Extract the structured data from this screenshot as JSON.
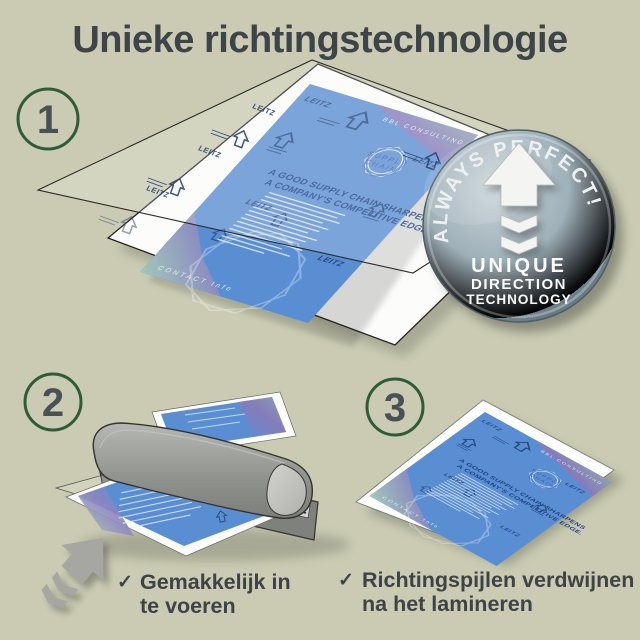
{
  "title": "Unieke richtingstechnologie",
  "steps": [
    {
      "number": "1"
    },
    {
      "number": "2"
    },
    {
      "number": "3"
    }
  ],
  "badge": {
    "arc_text": "ALWAYS PERFECT!",
    "lines": [
      "UNIQUE",
      "DIRECTION",
      "TECHNOLOGY"
    ]
  },
  "flyer": {
    "brand": "LEITZ",
    "top_band": "BBL CONSULTING",
    "logo_top": "SUPPLY",
    "logo_bottom": "CHAIN",
    "headline_1": "A GOOD SUPPLY CHAIN SHARPENS",
    "headline_2": "A COMPANY'S COMPETITIVE EDGE.",
    "bottom_band": "CONTACT Info"
  },
  "checklist": [
    {
      "mark": "✓",
      "line1": "Gemakkelijk in",
      "line2": "te voeren"
    },
    {
      "mark": "✓",
      "line1": "Richtingspijlen verdwijnen",
      "line2": "na het lamineren"
    }
  ],
  "colors": {
    "background": "#cacbb2",
    "title_text": "#3e454a",
    "accent_green": "#2e5c39",
    "flyer_blue": "#5a8ed3",
    "badge_steel": "#8fa0ab"
  }
}
